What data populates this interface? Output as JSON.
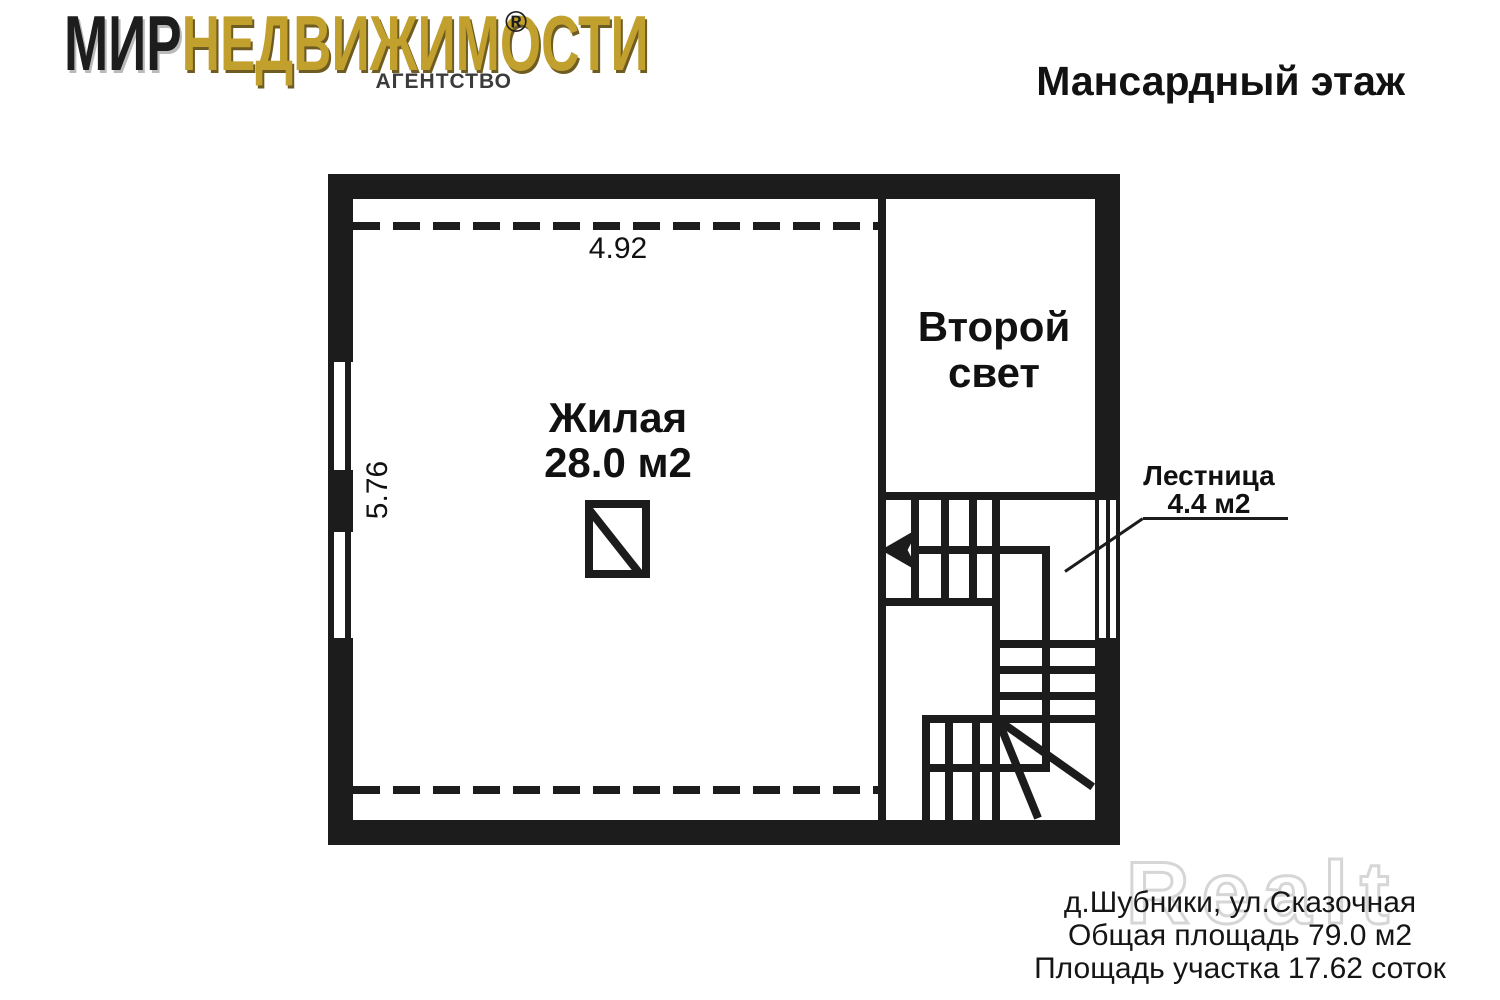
{
  "logo": {
    "part1": "МИР",
    "part2": "НЕДВИЖИМОСТИ",
    "registered": "®",
    "subtitle": "АГЕНТСТВО",
    "gold_color": "#c2a02e",
    "dark_color": "#1d1d1d"
  },
  "header": {
    "title": "Мансардный этаж"
  },
  "plan": {
    "wall_color": "#1c1c1c",
    "rooms": {
      "living": {
        "name": "Жилая",
        "area": "28.0 м2"
      },
      "second_light": {
        "line1": "Второй",
        "line2": "свет"
      }
    },
    "stairs": {
      "name": "Лестница",
      "area": "4.4 м2"
    },
    "dimensions": {
      "top_width": "4.92",
      "left_height": "5.76"
    }
  },
  "footer": {
    "watermark": "Realt",
    "lines": [
      "д.Шубники, ул.Сказочная",
      "Общая площадь 79.0 м2",
      "Площадь участка 17.62 соток"
    ]
  }
}
